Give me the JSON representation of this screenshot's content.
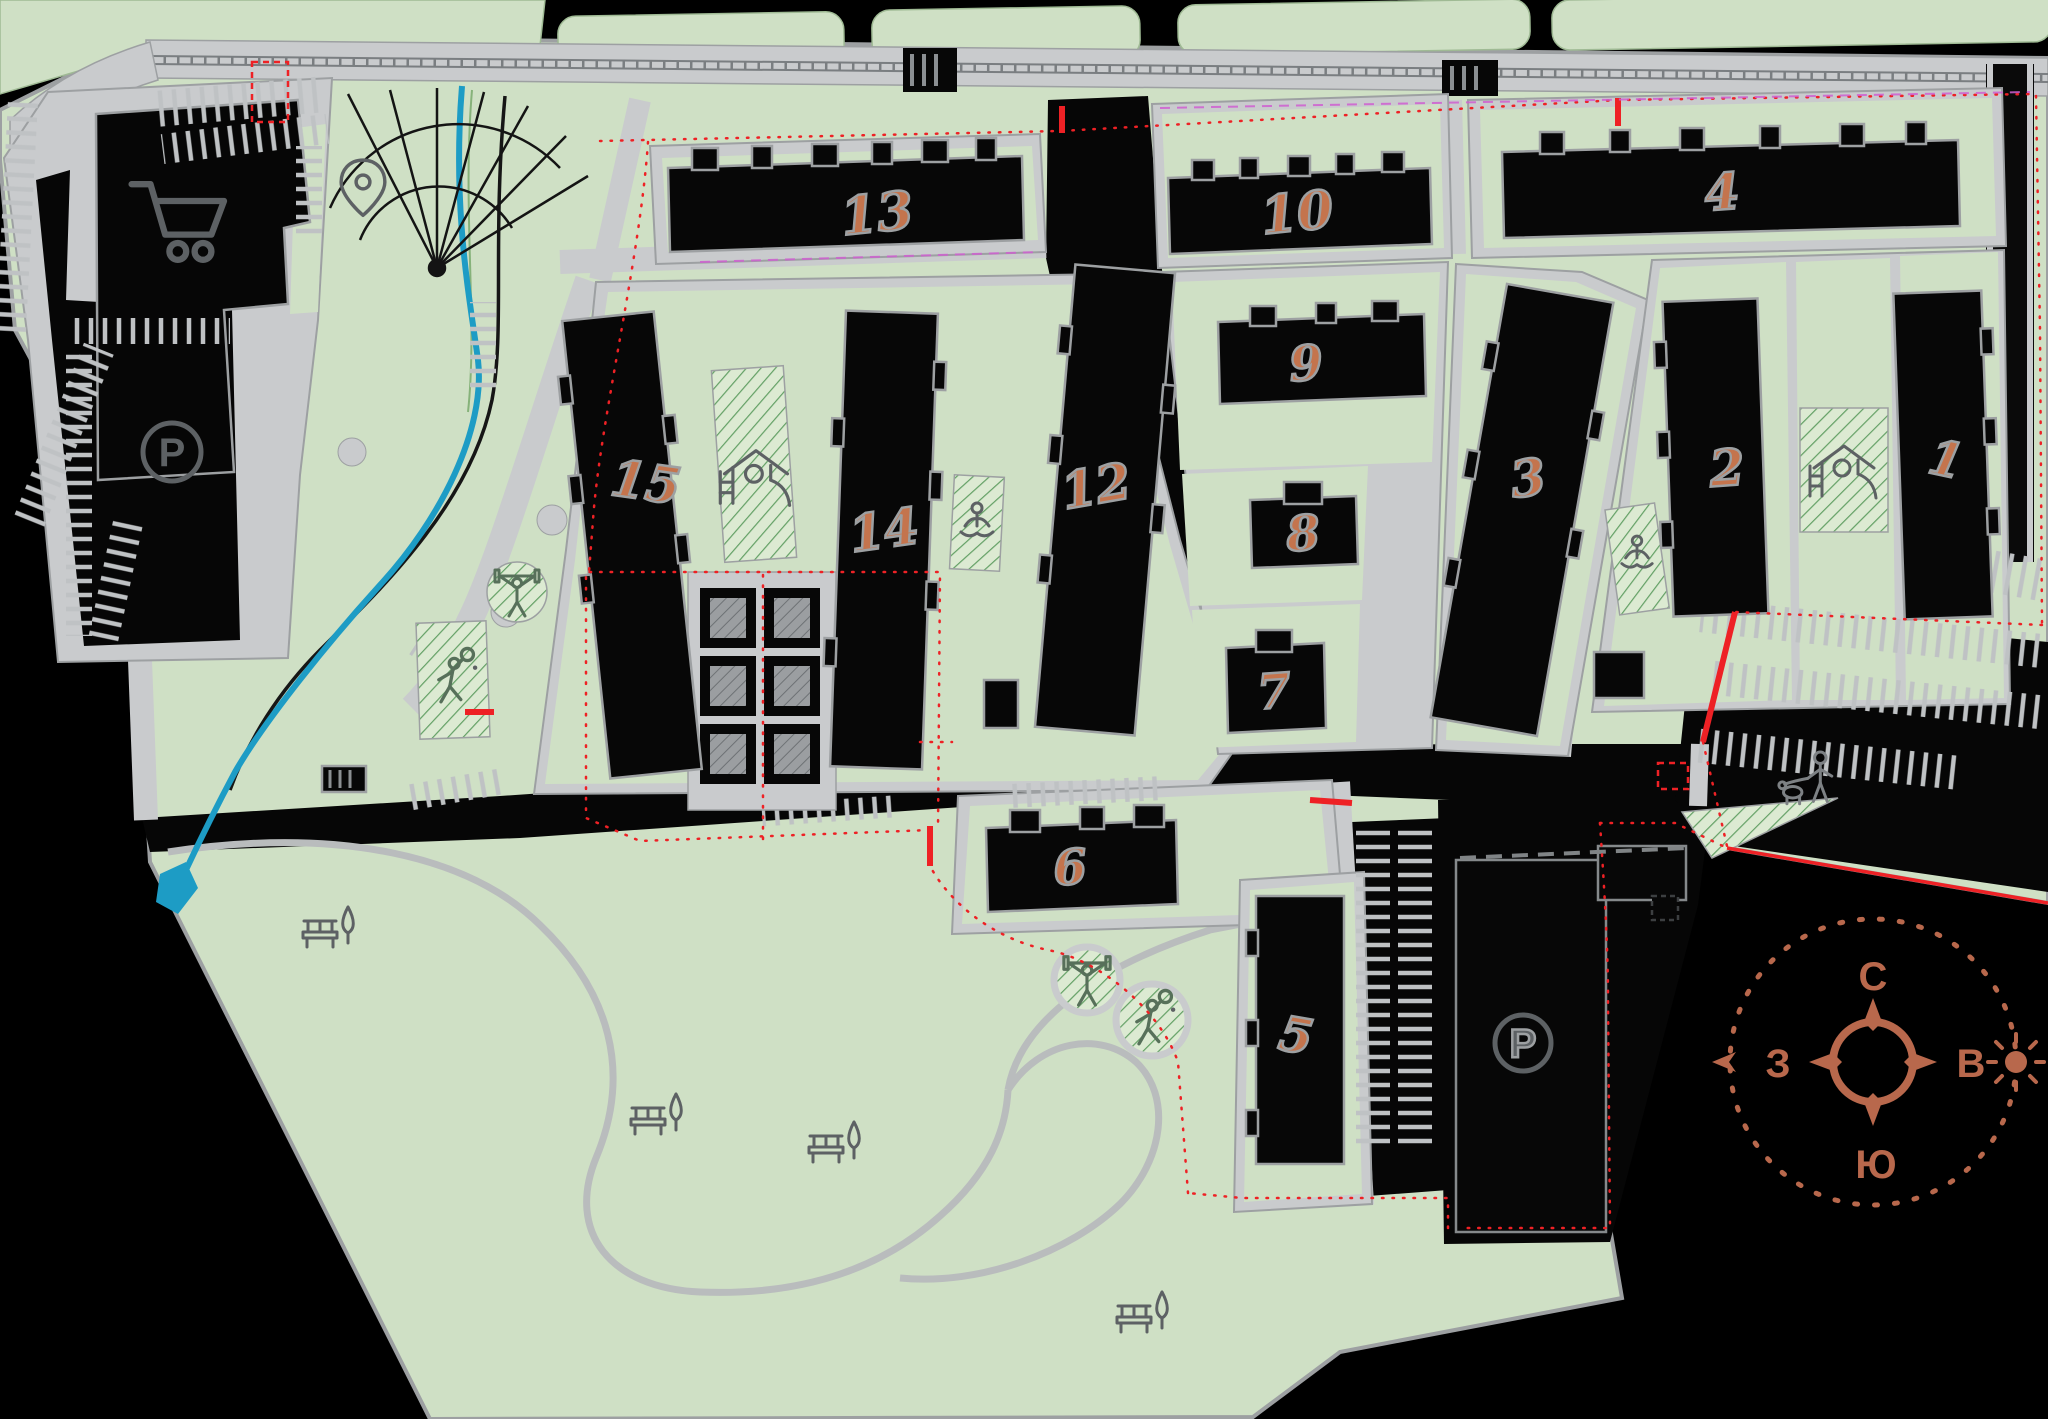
{
  "buildings": [
    {
      "label": "1"
    },
    {
      "label": "2"
    },
    {
      "label": "3"
    },
    {
      "label": "4"
    },
    {
      "label": "5"
    },
    {
      "label": "6"
    },
    {
      "label": "7"
    },
    {
      "label": "8"
    },
    {
      "label": "9"
    },
    {
      "label": "10"
    },
    {
      "label": "11"
    },
    {
      "label": "12"
    },
    {
      "label": "13"
    },
    {
      "label": "14"
    },
    {
      "label": "15"
    }
  ],
  "parking": {
    "label": "P"
  },
  "compass": {
    "north": "С",
    "east": "В",
    "south": "Ю",
    "west": "З"
  },
  "colors": {
    "background": "#000000",
    "site_green": "#cfe0c5",
    "hatch_base": "#dcead2",
    "hatch_line": "#63a065",
    "road_gray": "#c9cbcd",
    "road_edge": "#9da0a2",
    "building_black": "#070707",
    "number_orange": "#c4744d",
    "boundary_red": "#ee2125",
    "stream_blue": "#1d9cc5",
    "compass_terracotta": "#b8684c",
    "icon_gray": "#5d6164"
  },
  "icons": [
    "shopping-cart",
    "location-pin",
    "parking",
    "playground-slide",
    "weightlifter",
    "tennis-player",
    "yoga-person",
    "dog-walker",
    "bench",
    "tree",
    "sun",
    "compass-rose"
  ]
}
